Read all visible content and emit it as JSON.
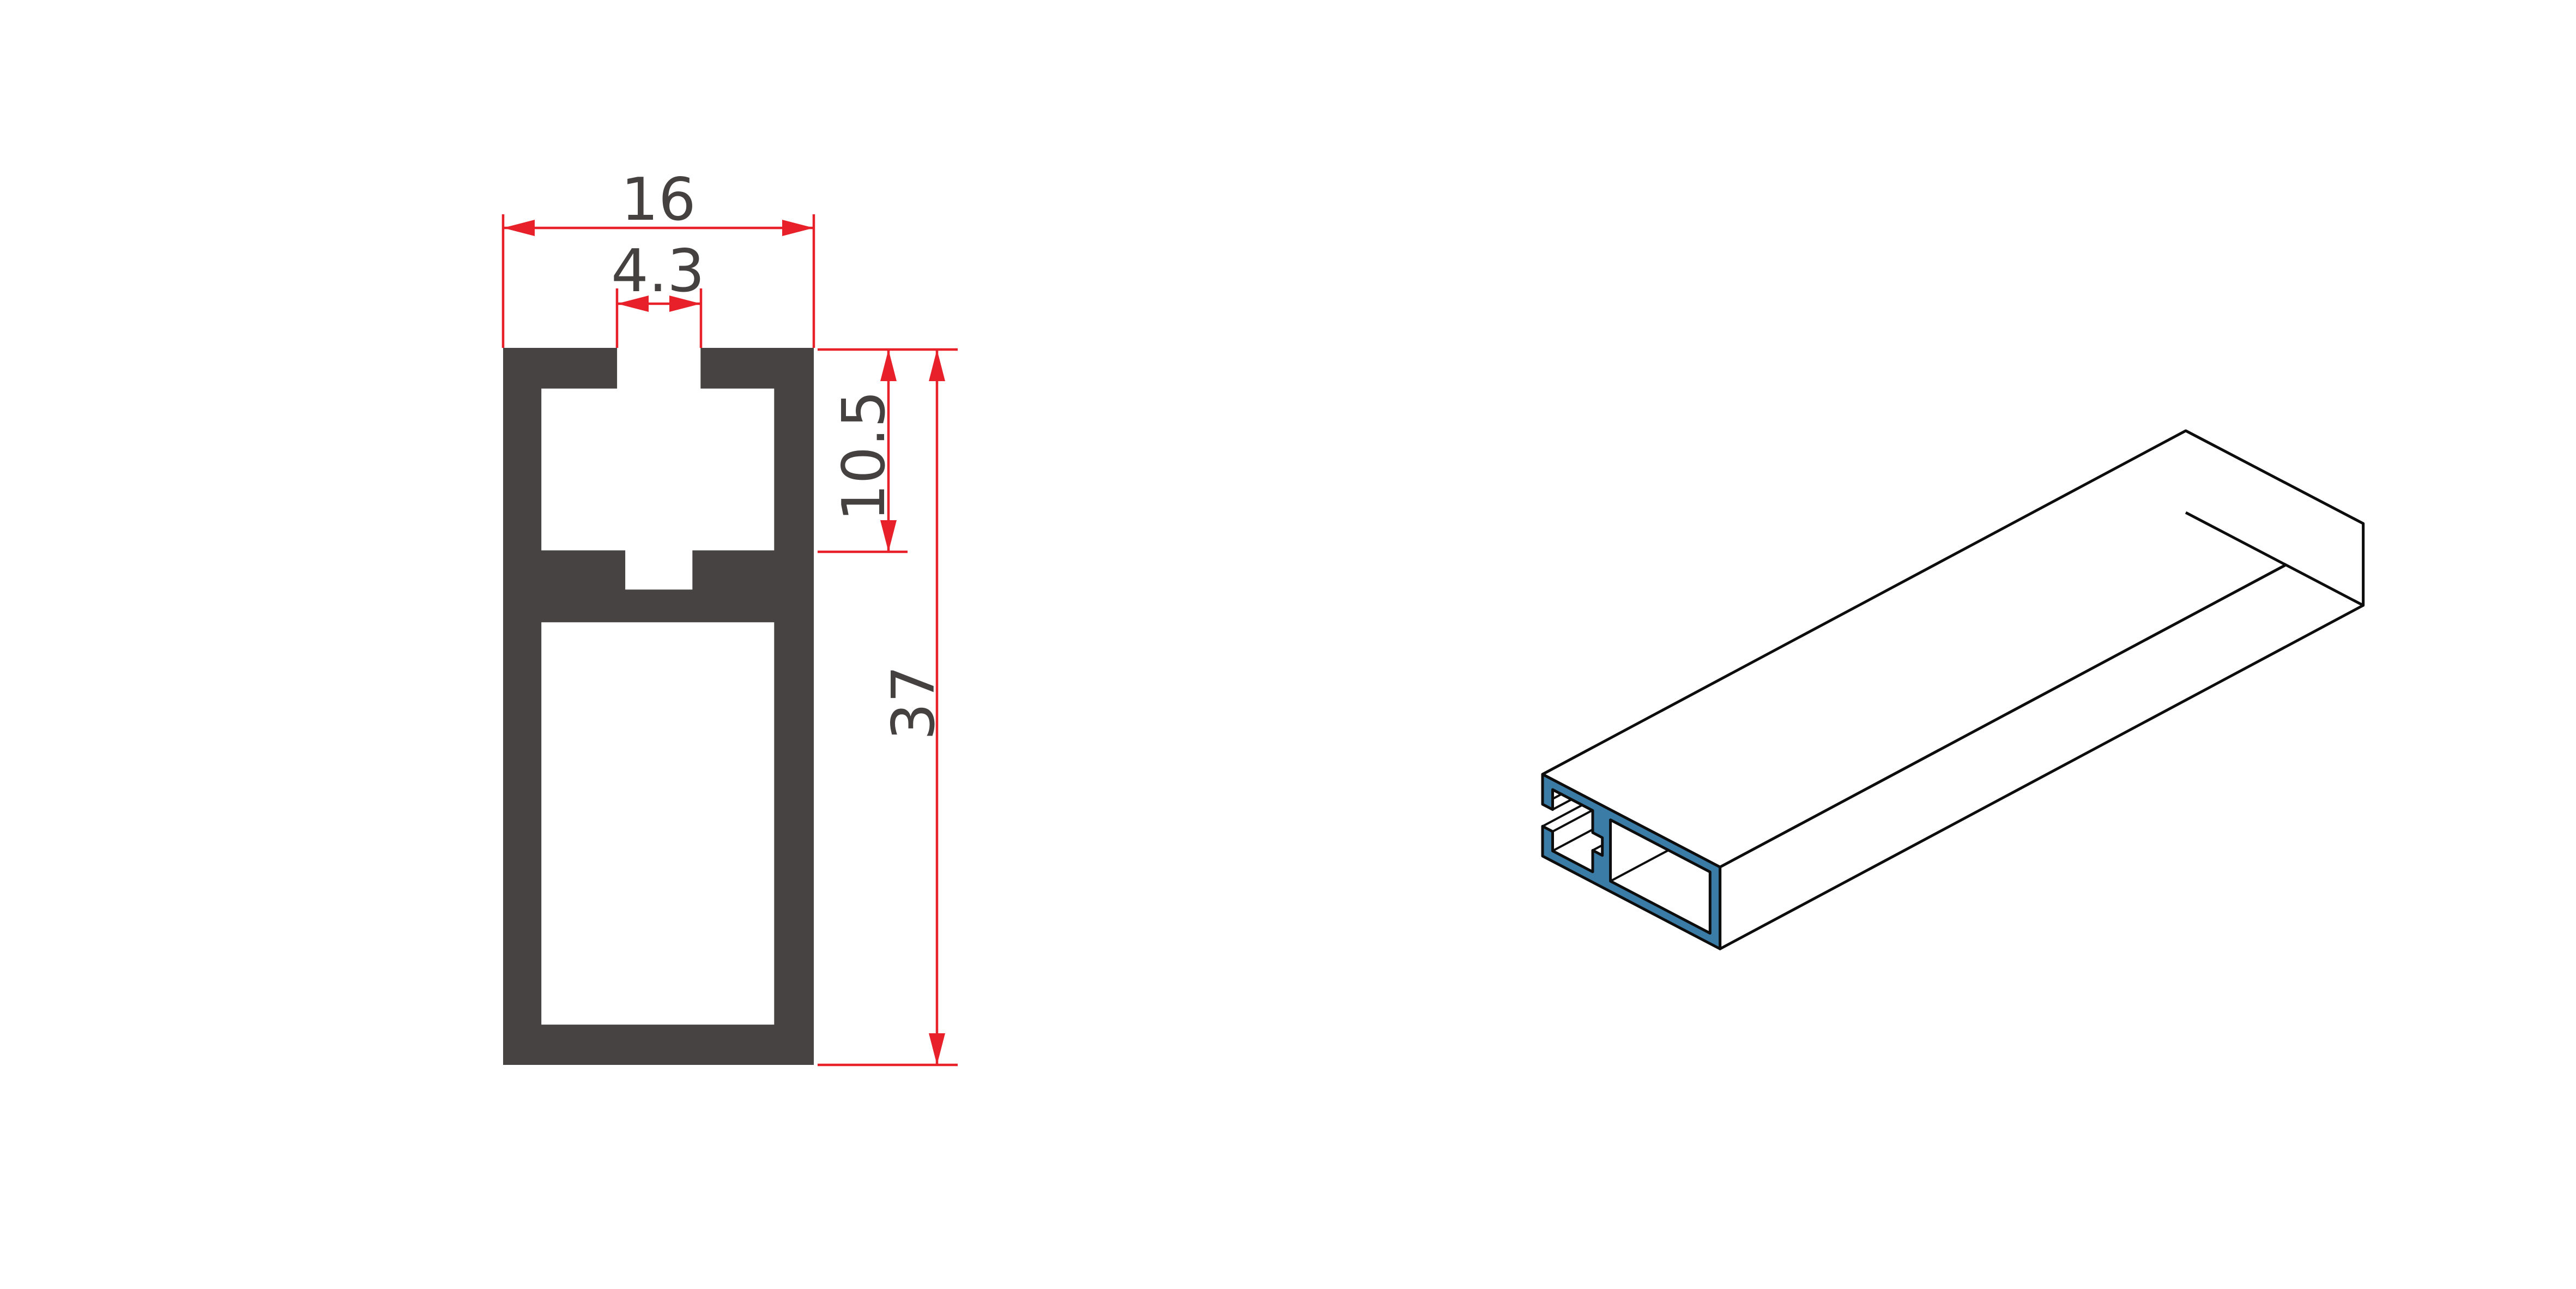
{
  "drawing": {
    "kind": "aluminium-extrusion-profile-technical-drawing",
    "views": {
      "cross_section": {
        "dimensions": {
          "width": {
            "label": "16",
            "value_mm": 16,
            "orientation": "horizontal",
            "measures": "overall profile width"
          },
          "slot_width": {
            "label": "4.3",
            "value_mm": 4.3,
            "orientation": "horizontal",
            "measures": "top slot opening width"
          },
          "groove_depth": {
            "label": "10.5",
            "value_mm": 10.5,
            "orientation": "vertical",
            "measures": "depth from top to upper cavity floor"
          },
          "height": {
            "label": "37",
            "value_mm": 37,
            "orientation": "vertical",
            "measures": "overall profile height"
          }
        }
      },
      "isometric": {
        "description": "extruded bar lying flat, near end cut face highlighted",
        "section_highlight": true
      }
    },
    "profile_mm": {
      "width": 16,
      "height": 37,
      "outline": [
        [
          0,
          0
        ],
        [
          5.87,
          0
        ],
        [
          5.87,
          2.1
        ],
        [
          1.97,
          2.1
        ],
        [
          1.97,
          10.45
        ],
        [
          6.29,
          10.45
        ],
        [
          6.29,
          12.47
        ],
        [
          9.75,
          12.47
        ],
        [
          9.75,
          10.45
        ],
        [
          13.96,
          10.45
        ],
        [
          13.96,
          2.1
        ],
        [
          10.17,
          2.1
        ],
        [
          10.17,
          0
        ],
        [
          16,
          0
        ],
        [
          16,
          37
        ],
        [
          0,
          37
        ]
      ],
      "lower_cavity": [
        [
          1.97,
          14.16
        ],
        [
          13.96,
          14.16
        ],
        [
          13.96,
          34.92
        ],
        [
          1.97,
          34.92
        ]
      ],
      "upper_cavity": [
        [
          5.87,
          0
        ],
        [
          5.87,
          2.1
        ],
        [
          1.97,
          2.1
        ],
        [
          1.97,
          10.45
        ],
        [
          6.29,
          10.45
        ],
        [
          6.29,
          12.47
        ],
        [
          9.75,
          12.47
        ],
        [
          9.75,
          10.45
        ],
        [
          13.96,
          10.45
        ],
        [
          13.96,
          2.1
        ],
        [
          10.17,
          2.1
        ],
        [
          10.17,
          0
        ]
      ]
    },
    "colors": {
      "background": "#ffffff",
      "profile_fill": "#474342",
      "dimension_red": "#e8202a",
      "text_dark": "#454140",
      "section_blue": "#3a7ca6",
      "edge_black": "#0d0d0d",
      "face_white": "#ffffff"
    }
  }
}
